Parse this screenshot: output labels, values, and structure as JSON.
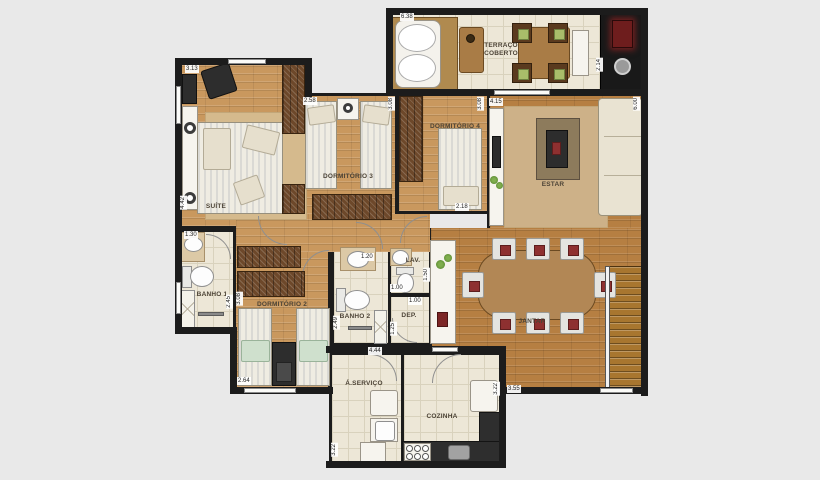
{
  "colors": {
    "background": "#e9e9e9",
    "wall": "#1c1c1c",
    "wood_light": "#c9985e",
    "wood_dark": "#b67f42",
    "tile": "#ede7d7",
    "wardrobe": "#6d482a",
    "counter_dark": "#2e2e2e",
    "rug": "#d5ba8d",
    "chair_cushion_red": "#8e3030",
    "terrace_cushion_green": "#a9bd6a"
  },
  "rooms": {
    "terraco": {
      "label": "TERRAÇO COBERTO",
      "dim_width": "6.38",
      "dim_depth": "2.14"
    },
    "suite": {
      "label": "SUÍTE",
      "dim_width": "3.13",
      "dim_depth": "4.42"
    },
    "dormitorio3": {
      "label": "DORMITÓRIO 3",
      "dim_width": "2.58",
      "dim_depth": "3.08"
    },
    "dormitorio4": {
      "label": "DORMITÓRIO 4",
      "dim_width": "2.18",
      "dim_depth": "3.08"
    },
    "estar": {
      "label": "ESTAR",
      "dim_width": "4.15",
      "dim_depth": "6.00"
    },
    "jantar": {
      "label": "JANTAR",
      "dim_width": "3.55"
    },
    "banho1": {
      "label": "BANHO 1",
      "dim_width": "1.30",
      "dim_depth": "2.45"
    },
    "dormitorio2": {
      "label": "DORMITÓRIO 2",
      "dim_width": "2.64",
      "dim_depth": "3.08"
    },
    "banho2": {
      "label": "BANHO 2",
      "dim_width": "1.20",
      "dim_depth": "2.49"
    },
    "lav": {
      "label": "LAV.",
      "dim_width": "1.00",
      "dim_depth": "1.50"
    },
    "dep": {
      "label": "DEP.",
      "dim_width": "1.00",
      "dim_depth": "1.25"
    },
    "hall": {
      "dim_width": "4.44"
    },
    "servico": {
      "label": "Á.SERVIÇO",
      "dim_depth": "3.22"
    },
    "cozinha": {
      "label": "COZINHA",
      "dim_depth": "3.22"
    }
  }
}
